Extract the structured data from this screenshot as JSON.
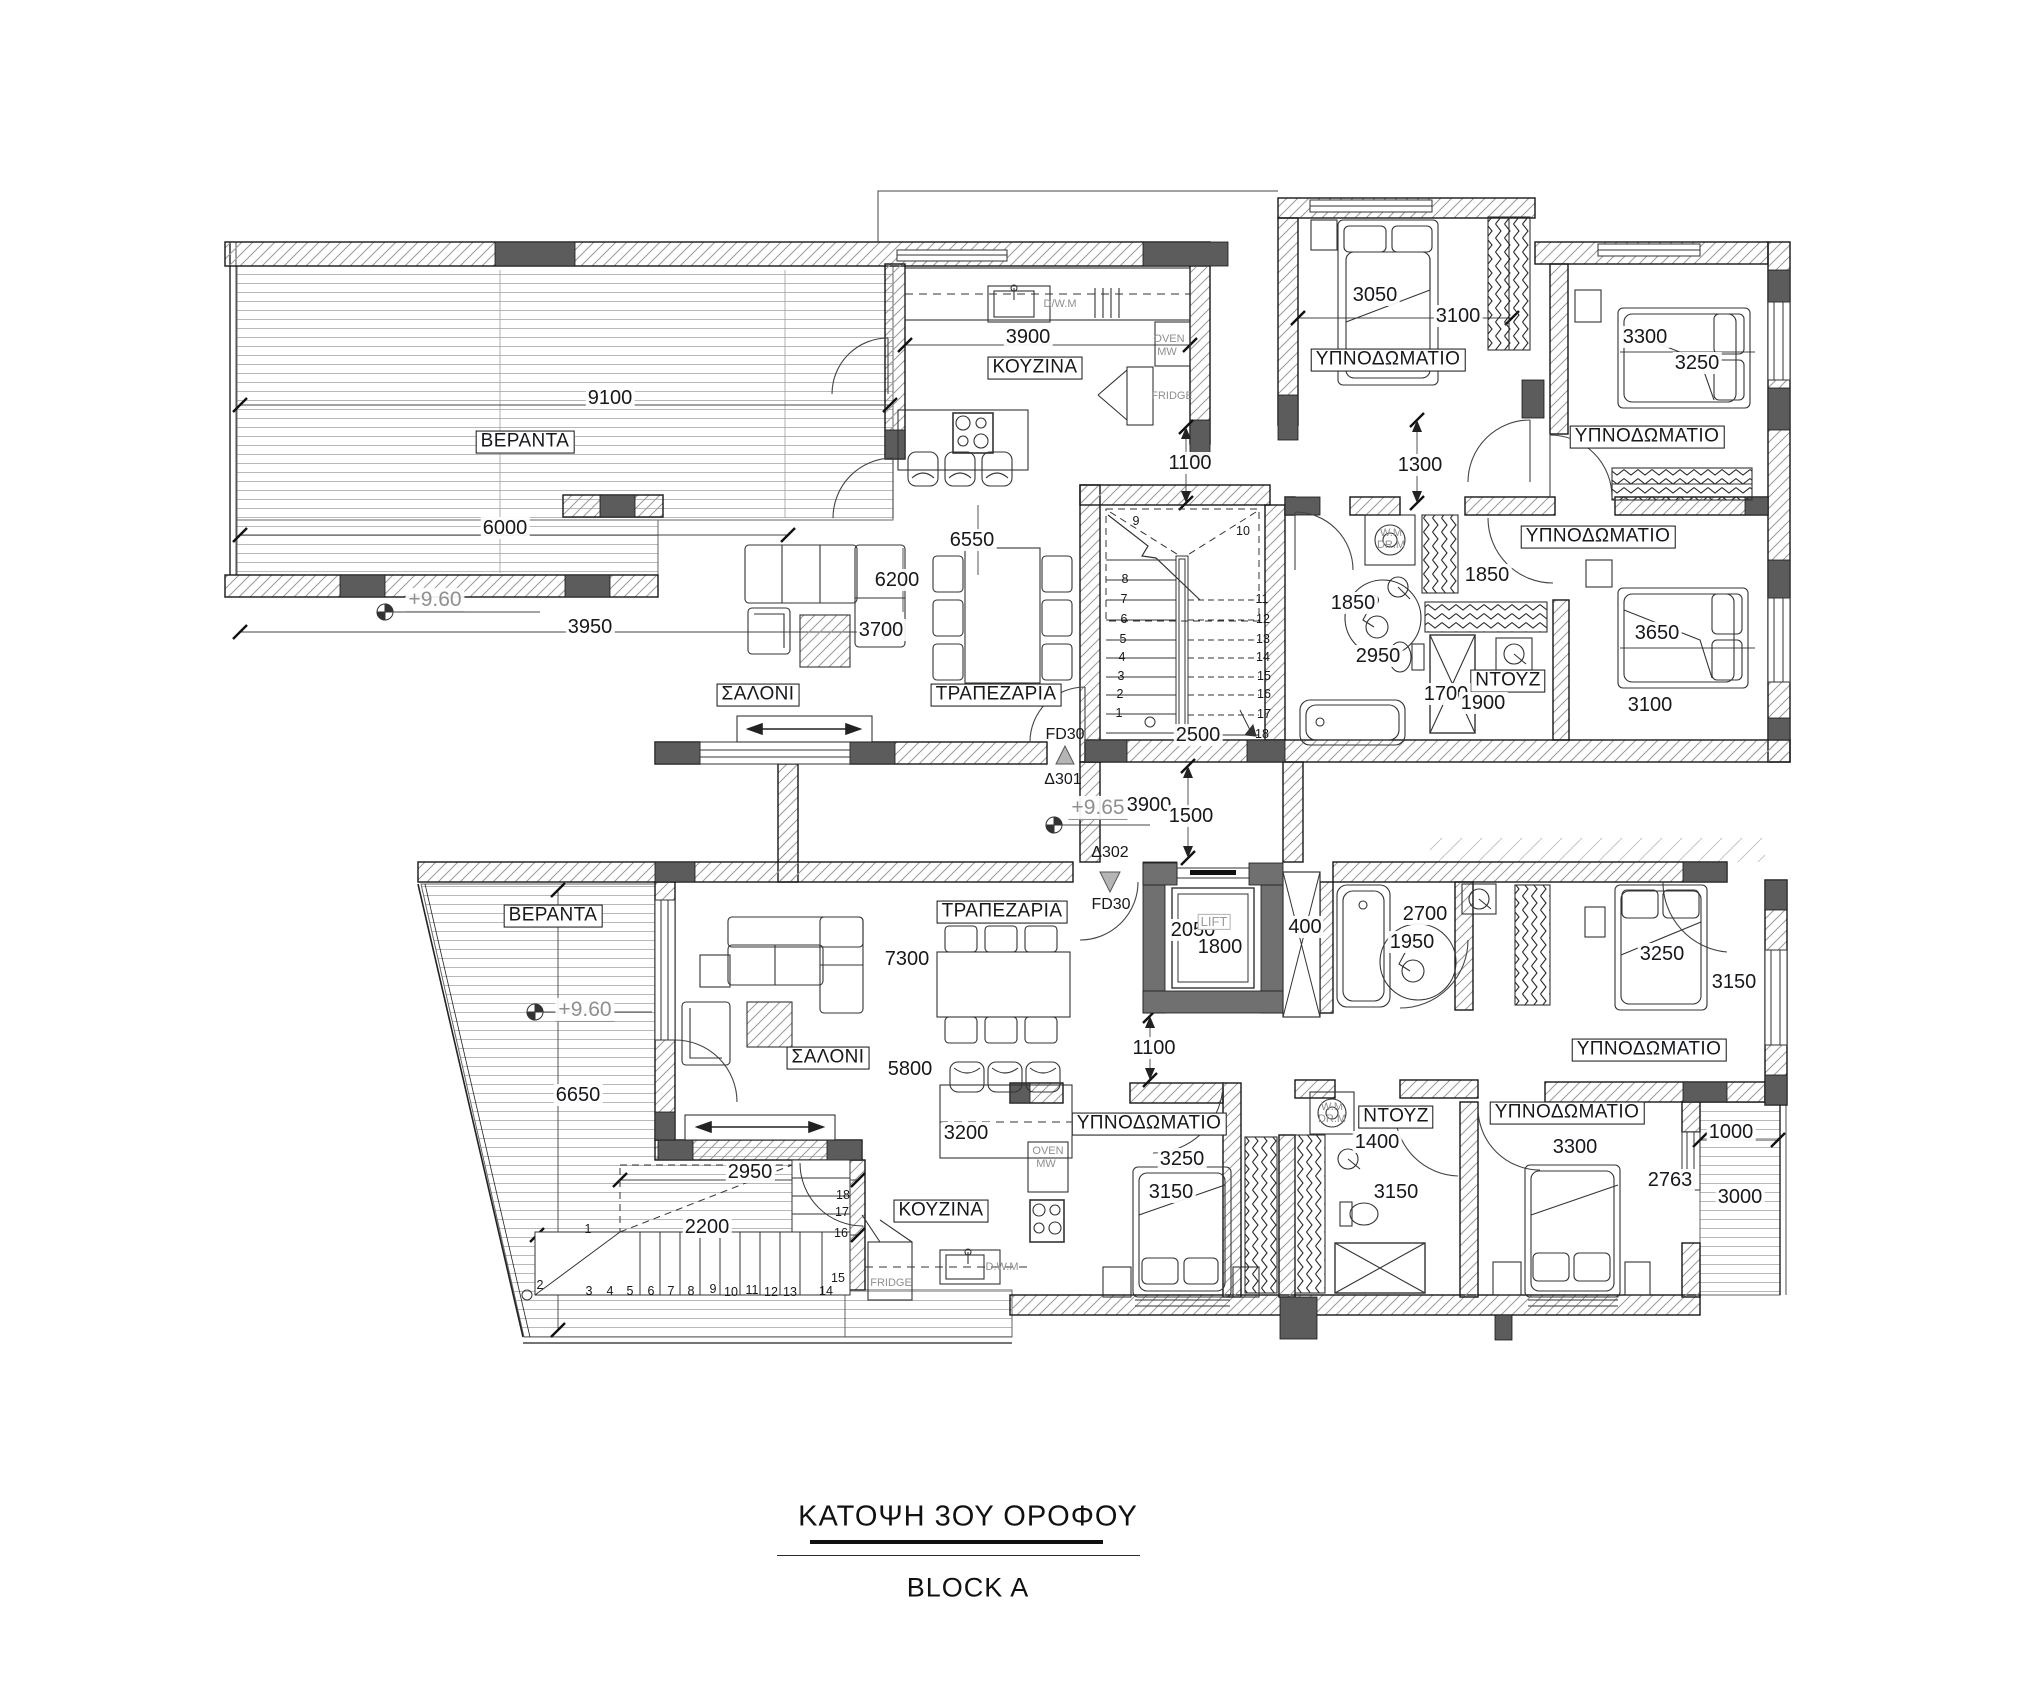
{
  "title": {
    "main": "ΚΑΤΟΨΗ 3ΟΥ ΟΡΟΦΟΥ",
    "block": "BLOCK A"
  },
  "colors": {
    "line": "#1a1a1a",
    "column_fill": "#5c5c5c",
    "lift_wall": "#707070",
    "gray_text": "#8f8f8f"
  },
  "labels": [
    {
      "t": "ΒΕΡΑΝΤΑ",
      "x": 525,
      "y": 442,
      "k": "room",
      "n": "room-label-veranda-top"
    },
    {
      "t": "ΚΟΥΖΙΝΑ",
      "x": 1035,
      "y": 368,
      "k": "room",
      "n": "room-label-kitchen-top"
    },
    {
      "t": "ΥΠΝΟΔΩΜΑΤΙΟ",
      "x": 1388,
      "y": 360,
      "k": "room",
      "n": "room-label-bedroom-1"
    },
    {
      "t": "ΥΠΝΟΔΩΜΑΤΙΟ",
      "x": 1647,
      "y": 437,
      "k": "room",
      "n": "room-label-bedroom-2"
    },
    {
      "t": "ΥΠΝΟΔΩΜΑΤΙΟ",
      "x": 1598,
      "y": 537,
      "k": "room",
      "n": "room-label-bedroom-3"
    },
    {
      "t": "ΣΑΛΟΝΙ",
      "x": 758,
      "y": 695,
      "k": "room",
      "n": "room-label-living-top"
    },
    {
      "t": "ΤΡΑΠΕΖΑΡΙΑ",
      "x": 996,
      "y": 695,
      "k": "room",
      "n": "room-label-dining-top"
    },
    {
      "t": "ΝΤΟΥΖ",
      "x": 1508,
      "y": 681,
      "k": "room",
      "n": "room-label-shower-top"
    },
    {
      "t": "ΤΡΑΠΕΖΑΡΙΑ",
      "x": 1002,
      "y": 912,
      "k": "room",
      "n": "room-label-dining-bottom"
    },
    {
      "t": "ΒΕΡΑΝΤΑ",
      "x": 553,
      "y": 916,
      "k": "room",
      "n": "room-label-veranda-bottom"
    },
    {
      "t": "ΣΑΛΟΝΙ",
      "x": 828,
      "y": 1058,
      "k": "room",
      "n": "room-label-living-bottom"
    },
    {
      "t": "ΚΟΥΖΙΝΑ",
      "x": 941,
      "y": 1211,
      "k": "room",
      "n": "room-label-kitchen-bottom"
    },
    {
      "t": "ΥΠΝΟΔΩΜΑΤΙΟ",
      "x": 1149,
      "y": 1124,
      "k": "room",
      "n": "room-label-bedroom-4"
    },
    {
      "t": "ΥΠΝΟΔΩΜΑΤΙΟ",
      "x": 1649,
      "y": 1050,
      "k": "room",
      "n": "room-label-bedroom-5"
    },
    {
      "t": "ΥΠΝΟΔΩΜΑΤΙΟ",
      "x": 1567,
      "y": 1113,
      "k": "room",
      "n": "room-label-bedroom-6"
    },
    {
      "t": "ΝΤΟΥΖ",
      "x": 1396,
      "y": 1117,
      "k": "room",
      "n": "room-label-shower-bottom"
    },
    {
      "t": "9100",
      "x": 610,
      "y": 398,
      "k": "dim"
    },
    {
      "t": "6000",
      "x": 505,
      "y": 528,
      "k": "dim"
    },
    {
      "t": "3950",
      "x": 590,
      "y": 627,
      "k": "dim"
    },
    {
      "t": "3900",
      "x": 1028,
      "y": 337,
      "k": "dim"
    },
    {
      "t": "6550",
      "x": 972,
      "y": 540,
      "k": "dim"
    },
    {
      "t": "6200",
      "x": 897,
      "y": 580,
      "k": "dim"
    },
    {
      "t": "3700",
      "x": 881,
      "y": 630,
      "k": "dim"
    },
    {
      "t": "1100",
      "x": 1190,
      "y": 463,
      "k": "dim"
    },
    {
      "t": "1300",
      "x": 1420,
      "y": 465,
      "k": "dim"
    },
    {
      "t": "3050",
      "x": 1375,
      "y": 295,
      "k": "dim"
    },
    {
      "t": "3100",
      "x": 1458,
      "y": 316,
      "k": "dim"
    },
    {
      "t": "3300",
      "x": 1645,
      "y": 337,
      "k": "dim"
    },
    {
      "t": "3250",
      "x": 1697,
      "y": 363,
      "k": "dim"
    },
    {
      "t": "1850",
      "x": 1487,
      "y": 575,
      "k": "dim"
    },
    {
      "t": "1850",
      "x": 1353,
      "y": 603,
      "k": "dim"
    },
    {
      "t": "2950",
      "x": 1378,
      "y": 656,
      "k": "dim"
    },
    {
      "t": "2500",
      "x": 1198,
      "y": 735,
      "k": "dim"
    },
    {
      "t": "1700",
      "x": 1446,
      "y": 694,
      "k": "dim"
    },
    {
      "t": "1900",
      "x": 1483,
      "y": 703,
      "k": "dim"
    },
    {
      "t": "3650",
      "x": 1657,
      "y": 633,
      "k": "dim"
    },
    {
      "t": "3100",
      "x": 1650,
      "y": 705,
      "k": "dim"
    },
    {
      "t": "3900",
      "x": 1149,
      "y": 805,
      "k": "dim"
    },
    {
      "t": "1500",
      "x": 1191,
      "y": 816,
      "k": "dim"
    },
    {
      "t": "2050",
      "x": 1193,
      "y": 930,
      "k": "dim"
    },
    {
      "t": "1800",
      "x": 1220,
      "y": 947,
      "k": "dim"
    },
    {
      "t": "400",
      "x": 1305,
      "y": 927,
      "k": "dim"
    },
    {
      "t": "2700",
      "x": 1425,
      "y": 914,
      "k": "dim"
    },
    {
      "t": "1950",
      "x": 1412,
      "y": 942,
      "k": "dim"
    },
    {
      "t": "1100",
      "x": 1154,
      "y": 1048,
      "k": "dim"
    },
    {
      "t": "7300",
      "x": 907,
      "y": 959,
      "k": "dim"
    },
    {
      "t": "5800",
      "x": 910,
      "y": 1069,
      "k": "dim"
    },
    {
      "t": "3200",
      "x": 966,
      "y": 1133,
      "k": "dim"
    },
    {
      "t": "2950",
      "x": 750,
      "y": 1172,
      "k": "dim"
    },
    {
      "t": "2200",
      "x": 707,
      "y": 1227,
      "k": "dim"
    },
    {
      "t": "6650",
      "x": 578,
      "y": 1095,
      "k": "dim"
    },
    {
      "t": "3250",
      "x": 1662,
      "y": 954,
      "k": "dim"
    },
    {
      "t": "3150",
      "x": 1734,
      "y": 982,
      "k": "dim"
    },
    {
      "t": "3250",
      "x": 1182,
      "y": 1159,
      "k": "dim"
    },
    {
      "t": "3150",
      "x": 1171,
      "y": 1192,
      "k": "dim"
    },
    {
      "t": "1400",
      "x": 1377,
      "y": 1142,
      "k": "dim"
    },
    {
      "t": "3150",
      "x": 1396,
      "y": 1192,
      "k": "dim"
    },
    {
      "t": "3300",
      "x": 1575,
      "y": 1147,
      "k": "dim"
    },
    {
      "t": "2763",
      "x": 1670,
      "y": 1180,
      "k": "dim"
    },
    {
      "t": "1000",
      "x": 1731,
      "y": 1132,
      "k": "dim"
    },
    {
      "t": "3000",
      "x": 1740,
      "y": 1197,
      "k": "dim"
    },
    {
      "t": "+9.60",
      "x": 435,
      "y": 600,
      "k": "level",
      "n": "level-label"
    },
    {
      "t": "+9.65",
      "x": 1098,
      "y": 808,
      "k": "level",
      "n": "level-label"
    },
    {
      "t": "+9.60",
      "x": 585,
      "y": 1010,
      "k": "level",
      "n": "level-label"
    },
    {
      "t": "D/W.M",
      "x": 1060,
      "y": 304,
      "k": "gray",
      "n": "appliance-label-dishwasher"
    },
    {
      "t": "OVEN",
      "x": 1169,
      "y": 339,
      "k": "gray",
      "n": "appliance-label-oven"
    },
    {
      "t": "MW",
      "x": 1167,
      "y": 352,
      "k": "gray",
      "n": "appliance-label-microwave"
    },
    {
      "t": "FRIDGE",
      "x": 1172,
      "y": 396,
      "k": "gray",
      "n": "appliance-label-fridge"
    },
    {
      "t": "W.M",
      "x": 1391,
      "y": 533,
      "k": "gray",
      "n": "appliance-label-washer"
    },
    {
      "t": "DR.M",
      "x": 1391,
      "y": 545,
      "k": "gray",
      "n": "appliance-label-dryer"
    },
    {
      "t": "OVEN",
      "x": 1048,
      "y": 1151,
      "k": "gray",
      "n": "appliance-label-oven"
    },
    {
      "t": "MW",
      "x": 1046,
      "y": 1164,
      "k": "gray",
      "n": "appliance-label-microwave"
    },
    {
      "t": "FRIDGE",
      "x": 891,
      "y": 1283,
      "k": "gray",
      "n": "appliance-label-fridge"
    },
    {
      "t": "D.W.M",
      "x": 1002,
      "y": 1267,
      "k": "gray",
      "n": "appliance-label-dishwasher"
    },
    {
      "t": "W.M",
      "x": 1332,
      "y": 1107,
      "k": "gray",
      "n": "appliance-label-washer"
    },
    {
      "t": "DR.M",
      "x": 1332,
      "y": 1119,
      "k": "gray",
      "n": "appliance-label-dryer"
    },
    {
      "t": "LIFT",
      "x": 1214,
      "y": 922,
      "k": "lift",
      "n": "lift-label"
    },
    {
      "t": "FD30",
      "x": 1065,
      "y": 735,
      "k": "fd",
      "n": "fire-door-label"
    },
    {
      "t": "Δ301",
      "x": 1063,
      "y": 780,
      "k": "fd",
      "n": "door-tag-301"
    },
    {
      "t": "Δ302",
      "x": 1110,
      "y": 853,
      "k": "fd",
      "n": "door-tag-302"
    },
    {
      "t": "FD30",
      "x": 1111,
      "y": 905,
      "k": "fd",
      "n": "fire-door-label"
    },
    {
      "t": "9",
      "x": 1136,
      "y": 522,
      "k": "stair"
    },
    {
      "t": "10",
      "x": 1243,
      "y": 532,
      "k": "stair"
    },
    {
      "t": "8",
      "x": 1125,
      "y": 580,
      "k": "stair"
    },
    {
      "t": "7",
      "x": 1124,
      "y": 600,
      "k": "stair"
    },
    {
      "t": "6",
      "x": 1124,
      "y": 620,
      "k": "stair"
    },
    {
      "t": "5",
      "x": 1123,
      "y": 640,
      "k": "stair"
    },
    {
      "t": "4",
      "x": 1122,
      "y": 658,
      "k": "stair"
    },
    {
      "t": "3",
      "x": 1121,
      "y": 677,
      "k": "stair"
    },
    {
      "t": "2",
      "x": 1120,
      "y": 695,
      "k": "stair"
    },
    {
      "t": "1",
      "x": 1119,
      "y": 714,
      "k": "stair"
    },
    {
      "t": "11",
      "x": 1262,
      "y": 600,
      "k": "stair"
    },
    {
      "t": "12",
      "x": 1263,
      "y": 620,
      "k": "stair"
    },
    {
      "t": "13",
      "x": 1263,
      "y": 640,
      "k": "stair"
    },
    {
      "t": "14",
      "x": 1263,
      "y": 658,
      "k": "stair"
    },
    {
      "t": "15",
      "x": 1264,
      "y": 677,
      "k": "stair"
    },
    {
      "t": "16",
      "x": 1264,
      "y": 695,
      "k": "stair"
    },
    {
      "t": "17",
      "x": 1264,
      "y": 715,
      "k": "stair"
    },
    {
      "t": "18",
      "x": 1262,
      "y": 735,
      "k": "stair"
    },
    {
      "t": "1",
      "x": 588,
      "y": 1230,
      "k": "stair"
    },
    {
      "t": "2",
      "x": 540,
      "y": 1286,
      "k": "stair"
    },
    {
      "t": "3",
      "x": 589,
      "y": 1292,
      "k": "stair"
    },
    {
      "t": "4",
      "x": 610,
      "y": 1292,
      "k": "stair"
    },
    {
      "t": "5",
      "x": 630,
      "y": 1292,
      "k": "stair"
    },
    {
      "t": "6",
      "x": 651,
      "y": 1292,
      "k": "stair"
    },
    {
      "t": "7",
      "x": 671,
      "y": 1292,
      "k": "stair"
    },
    {
      "t": "8",
      "x": 691,
      "y": 1292,
      "k": "stair"
    },
    {
      "t": "9",
      "x": 713,
      "y": 1290,
      "k": "stair"
    },
    {
      "t": "10",
      "x": 731,
      "y": 1293,
      "k": "stair"
    },
    {
      "t": "11",
      "x": 752,
      "y": 1291,
      "k": "stair"
    },
    {
      "t": "12",
      "x": 771,
      "y": 1293,
      "k": "stair"
    },
    {
      "t": "13",
      "x": 790,
      "y": 1293,
      "k": "stair"
    },
    {
      "t": "14",
      "x": 826,
      "y": 1292,
      "k": "stair"
    },
    {
      "t": "15",
      "x": 838,
      "y": 1279,
      "k": "stair"
    },
    {
      "t": "16",
      "x": 841,
      "y": 1234,
      "k": "stair"
    },
    {
      "t": "17",
      "x": 842,
      "y": 1213,
      "k": "stair"
    },
    {
      "t": "18",
      "x": 843,
      "y": 1196,
      "k": "stair"
    }
  ]
}
